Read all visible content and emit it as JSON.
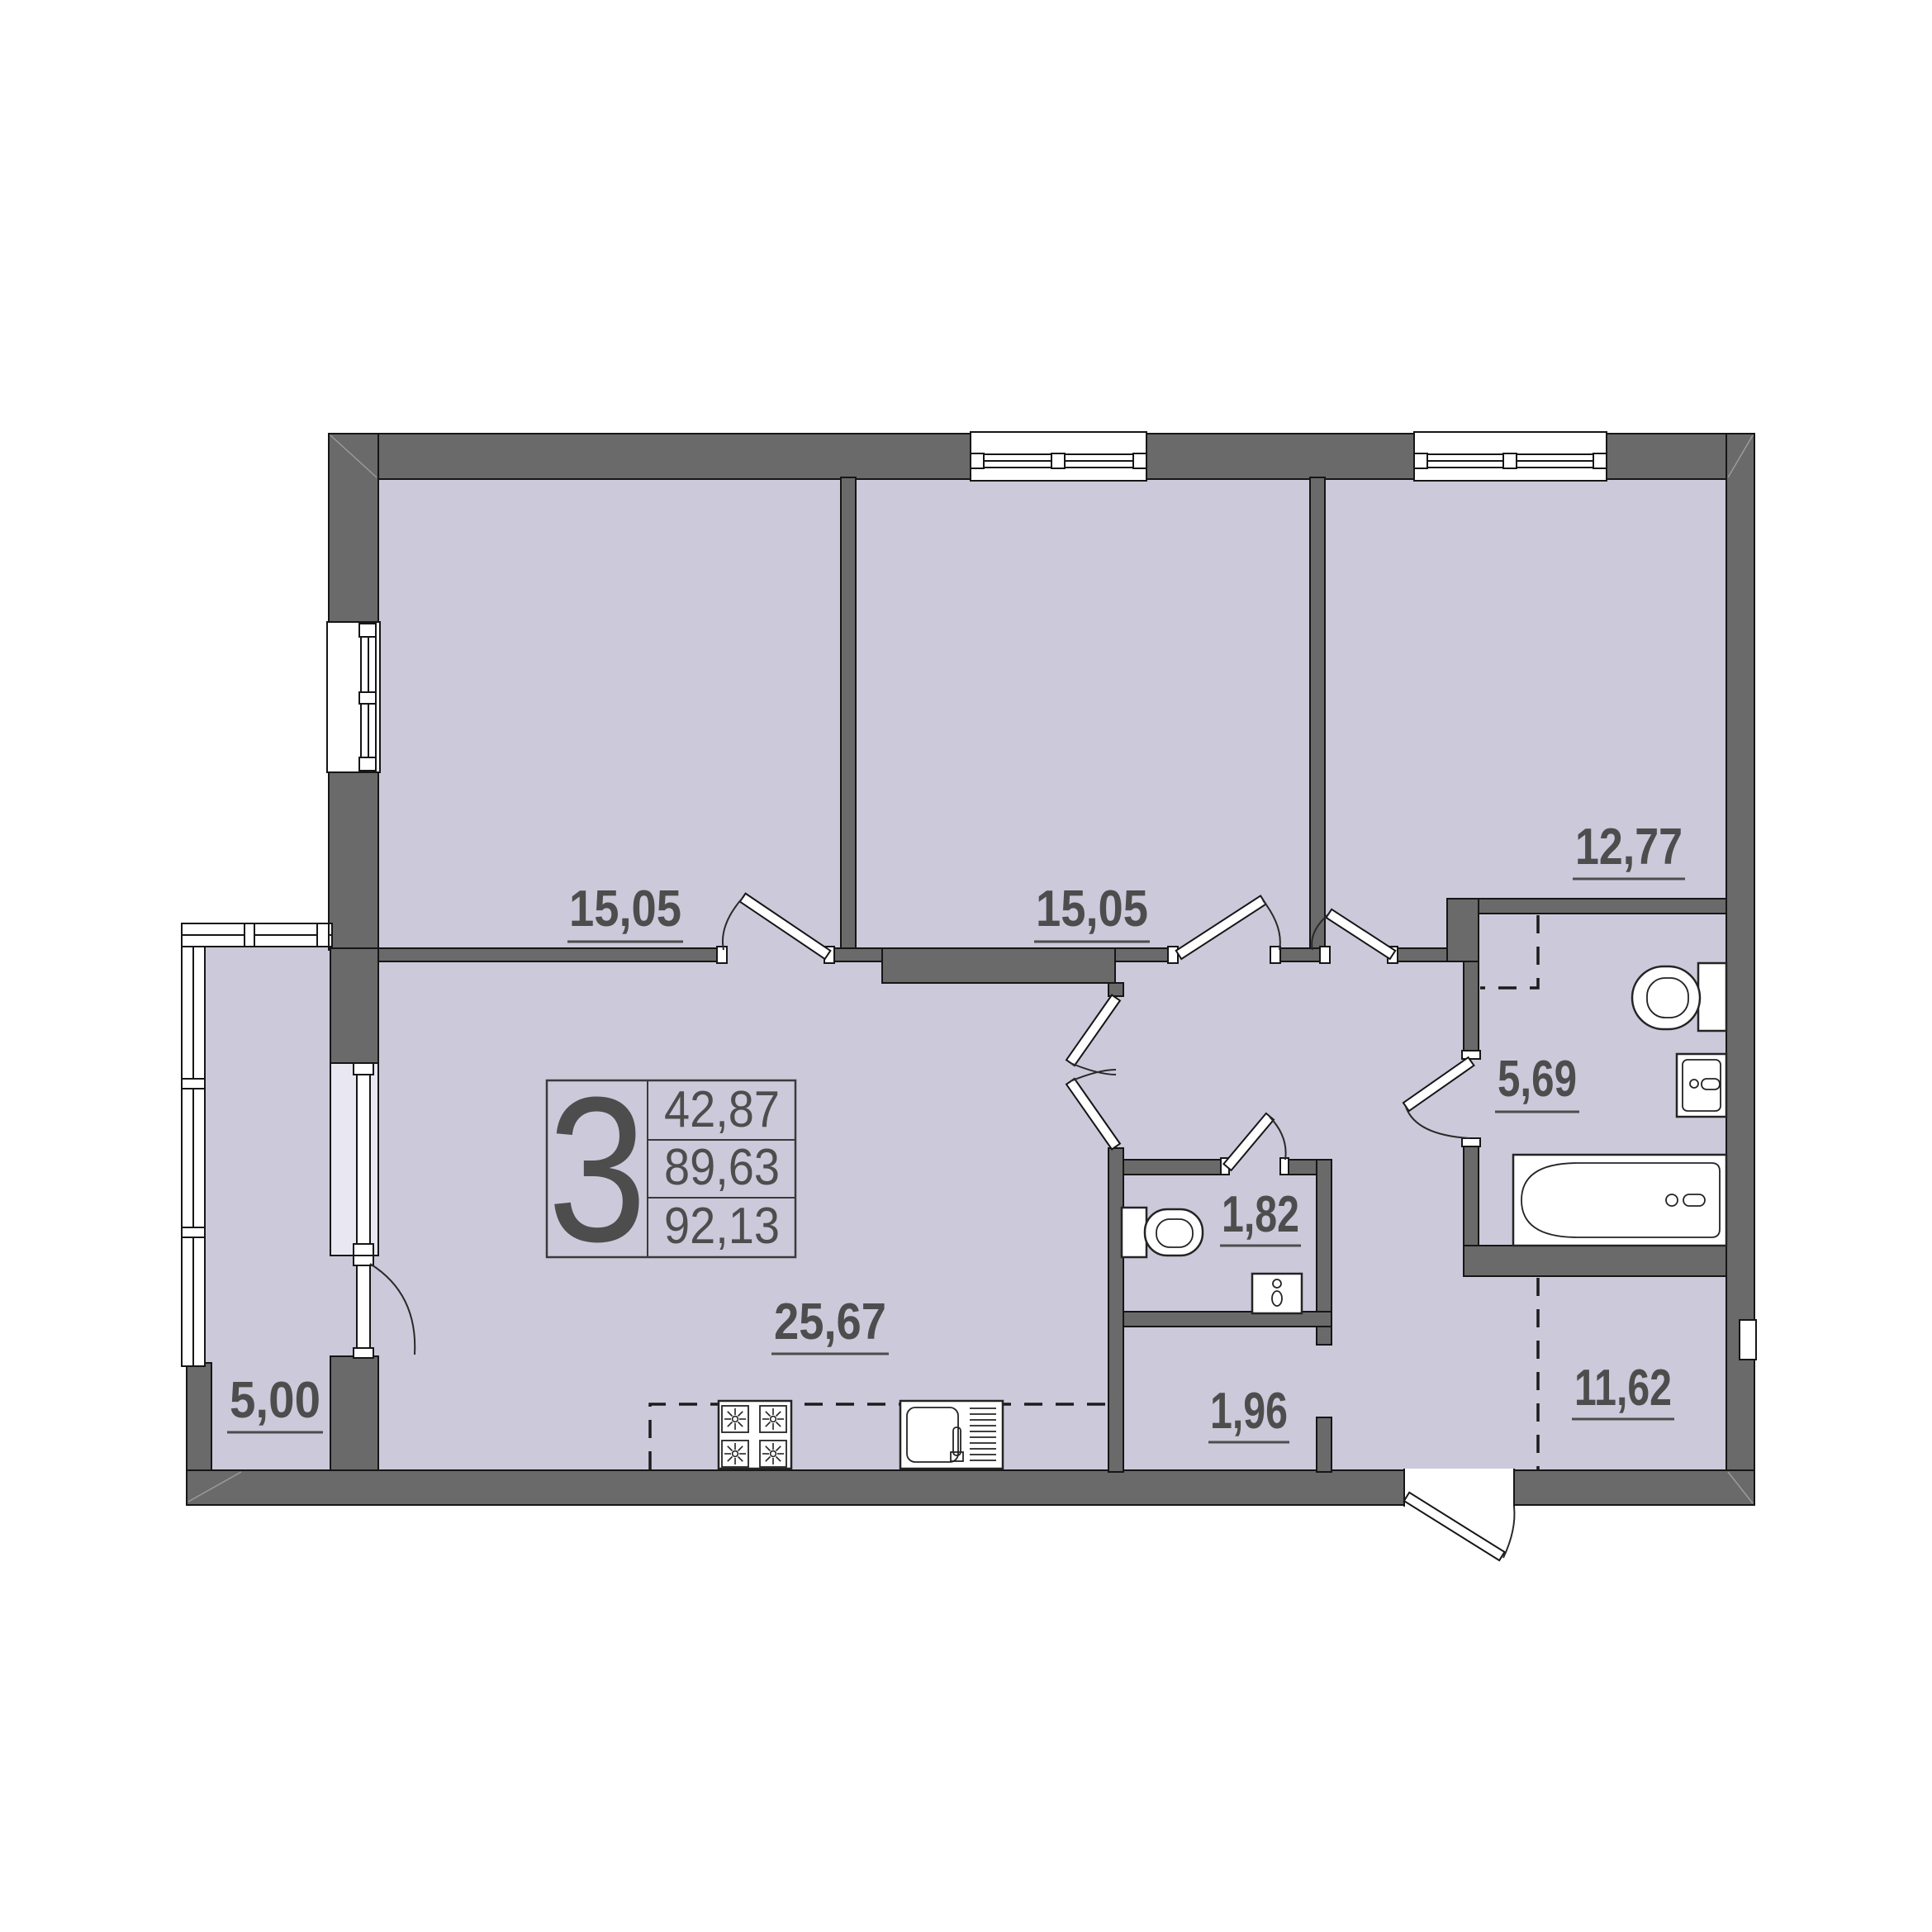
{
  "plan": {
    "type": "apartment-floor-plan",
    "rooms": [
      {
        "name": "bedroom-1",
        "area": "15,05"
      },
      {
        "name": "bedroom-2",
        "area": "15,05"
      },
      {
        "name": "bedroom-3",
        "area": "12,77"
      },
      {
        "name": "kitchen-living-room",
        "area": "25,67"
      },
      {
        "name": "bathroom",
        "area": "5,69"
      },
      {
        "name": "wc",
        "area": "1,82"
      },
      {
        "name": "corridor",
        "area": "1,96"
      },
      {
        "name": "hallway",
        "area": "11,62"
      },
      {
        "name": "balcony",
        "area": "5,00"
      }
    ],
    "legend": {
      "rooms_count": "3",
      "living_area": "42,87",
      "floor_area": "89,63",
      "total_area": "92,13"
    },
    "colors": {
      "wall": "#6a6a6a",
      "floor": "#ccc9da",
      "outline": "#161616",
      "text": "#4d4d4d",
      "window_glass": "#e9e7f1",
      "background": "#ffffff"
    }
  }
}
